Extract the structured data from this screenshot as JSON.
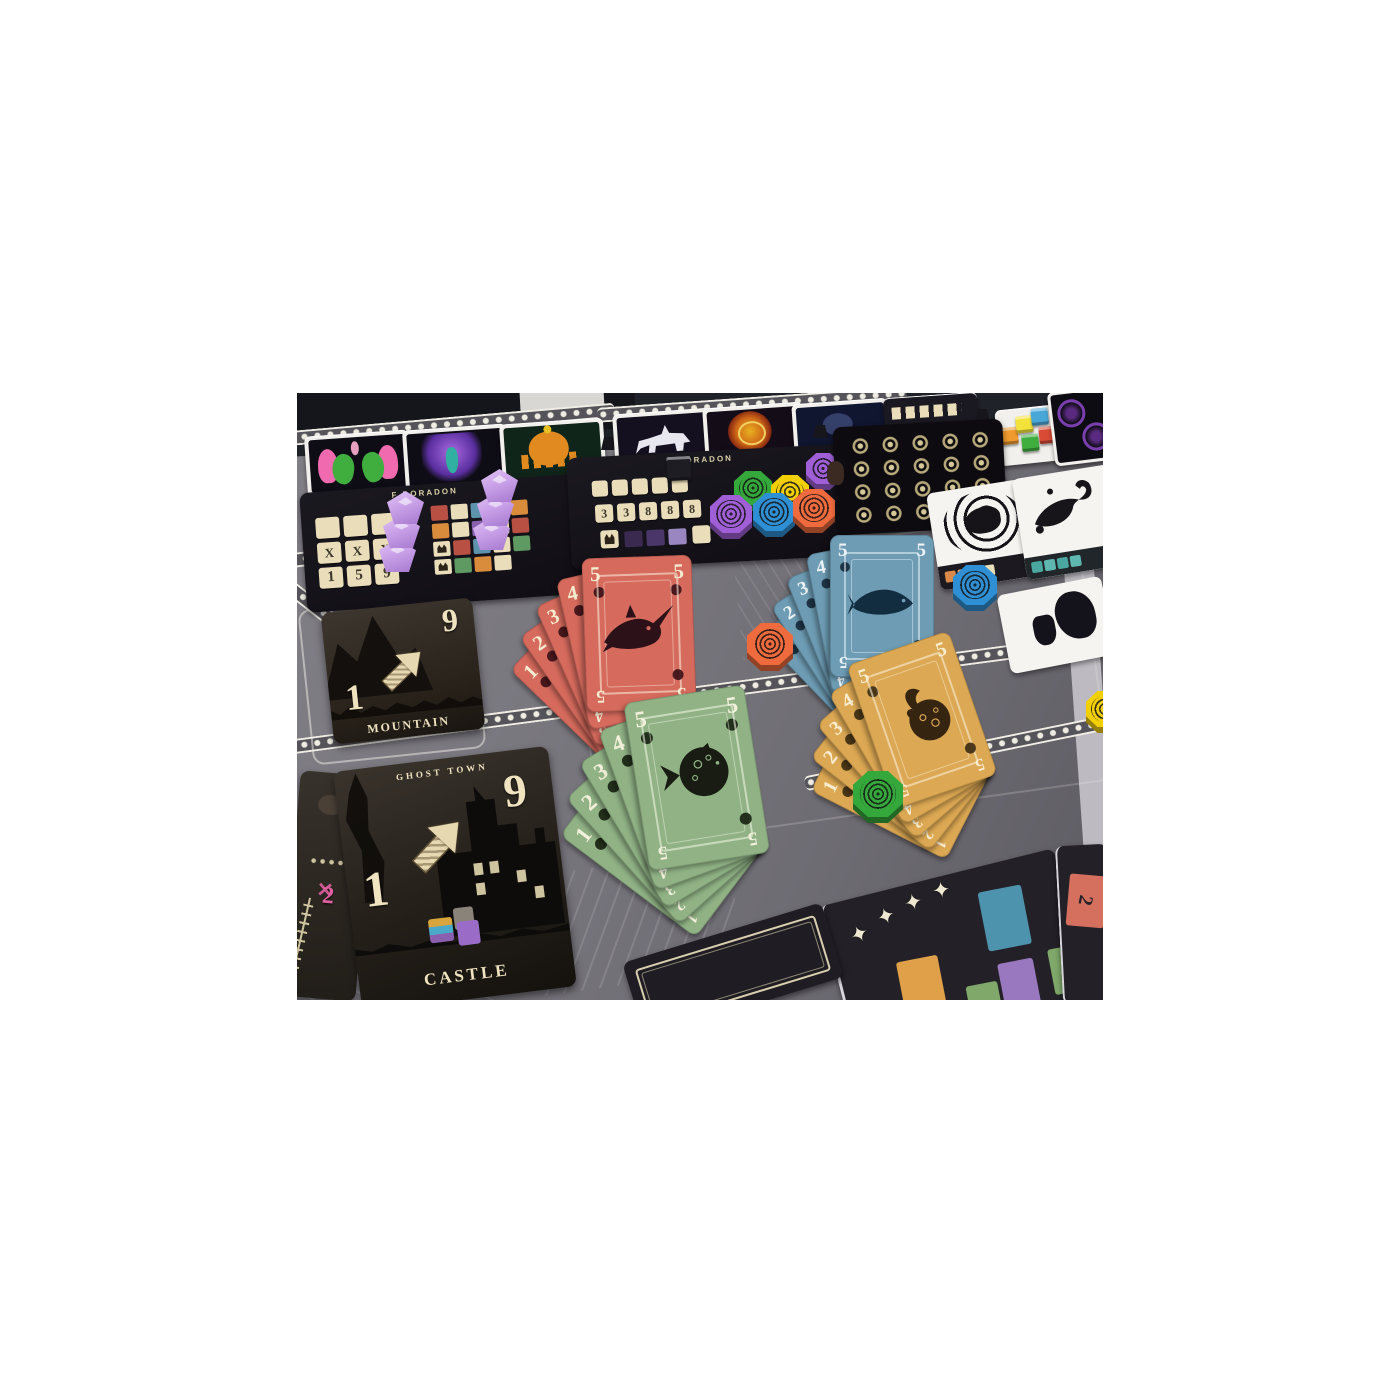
{
  "board": {
    "player_panel": {
      "title": "F DORADON",
      "score_rows": [
        [
          "",
          "",
          ""
        ],
        [
          "X",
          "X",
          "X"
        ],
        [
          "1",
          "5",
          "9"
        ]
      ]
    },
    "market_panel": {
      "title": "F DORADON",
      "number_tiles": [
        "3",
        "3",
        "8",
        "8",
        "8"
      ]
    }
  },
  "fans": {
    "red": {
      "fish": "swordfish",
      "cards": [
        "1",
        "2",
        "3",
        "4",
        "5"
      ]
    },
    "blue": {
      "fish": "salmon",
      "cards": [
        "1",
        "2",
        "3",
        "4",
        "5"
      ]
    },
    "green": {
      "fish": "pufferfish",
      "cards": [
        "1",
        "2",
        "3",
        "4",
        "5"
      ]
    },
    "yellow": {
      "fish": "fantail",
      "cards": [
        "1",
        "2",
        "3",
        "4",
        "5"
      ]
    }
  },
  "location_cards": {
    "mountain": {
      "title": "MOUNTAIN",
      "from": "1",
      "to": "9"
    },
    "castle": {
      "title": "CASTLE",
      "region": "GHOST TOWN",
      "from": "1",
      "to": "9"
    },
    "skeleton": {
      "value": "2"
    }
  },
  "misc": {
    "star_glyph": "✦",
    "x_mark": "✕",
    "edge_card_value": "2"
  },
  "colors": {
    "board_gray": "#76747b",
    "panel_black": "#15131a",
    "card_red": "#d56a5d",
    "card_blue": "#6d9cb4",
    "card_green": "#90b285",
    "card_yellow": "#dca853",
    "token_purple": "#a05fd6",
    "token_green": "#35a83b",
    "token_yellow": "#f2cf00",
    "token_blue": "#2f8fd4",
    "token_orange": "#ef6a3d",
    "gem_purple": "#c9a1e8",
    "tile_beige": "#e9ddba"
  }
}
